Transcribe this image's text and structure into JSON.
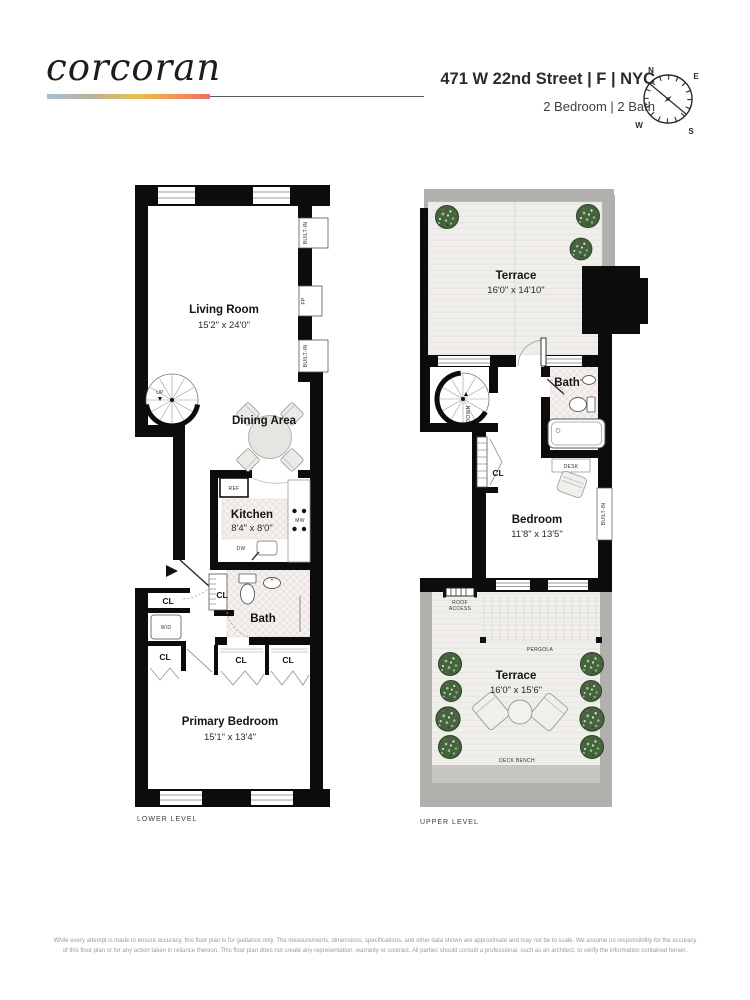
{
  "header": {
    "logo": "corcoran",
    "address": "471 W 22nd Street | F | NYC",
    "subtitle": "2 Bedroom | 2 Bath",
    "compass": {
      "n": "N",
      "e": "E",
      "s": "S",
      "w": "W"
    }
  },
  "labels": {
    "built_in": "BUILT-IN",
    "fp": "FP",
    "cl": "CL",
    "wd": "W/D",
    "ref": "REF",
    "mw": "MW",
    "dw": "DW",
    "up": "UP",
    "down": "DOWN",
    "desk": "DESK",
    "pergola": "PERGOLA",
    "roof_access_1": "ROOF",
    "roof_access_2": "ACCESS",
    "deck_bench": "DECK BENCH"
  },
  "lower_level": {
    "caption": "LOWER LEVEL",
    "living_room": {
      "name": "Living Room",
      "dims": "15'2\" x 24'0\""
    },
    "dining_area": {
      "name": "Dining Area"
    },
    "kitchen": {
      "name": "Kitchen",
      "dims": "8'4\" x 8'0\""
    },
    "bath": {
      "name": "Bath"
    },
    "primary_bedroom": {
      "name": "Primary Bedroom",
      "dims": "15'1\" x 13'4\""
    }
  },
  "upper_level": {
    "caption": "UPPER LEVEL",
    "terrace_top": {
      "name": "Terrace",
      "dims": "16'0\" x 14'10\""
    },
    "bath": {
      "name": "Bath"
    },
    "bedroom": {
      "name": "Bedroom",
      "dims": "11'8\" x 13'5\""
    },
    "terrace_main": {
      "name": "Terrace",
      "dims": "16'0\" x 15'6\""
    }
  },
  "footer": {
    "line1": "While every attempt is made to ensure accuracy, this floor plan is for guidance only. The measurements, dimensions, specifications, and other data shown are approximate and may not be to scale. We assume no responsibility for the accuracy",
    "line2": "of this floor plan or for any action taken in reliance thereon. This floor plan does not create any representation, warranty or contract. All parties should consult a professional, such as an architect, to verify the information contained herein."
  },
  "colors": {
    "wall": "#0c0c0c",
    "terrace_border": "#b2b0ac",
    "deck": "#f0eeea",
    "tile": "#f6f1ef",
    "plant": "#44633e",
    "accent_gradient": [
      "#a9bfd4",
      "#e8c050",
      "#ee6f62"
    ]
  }
}
